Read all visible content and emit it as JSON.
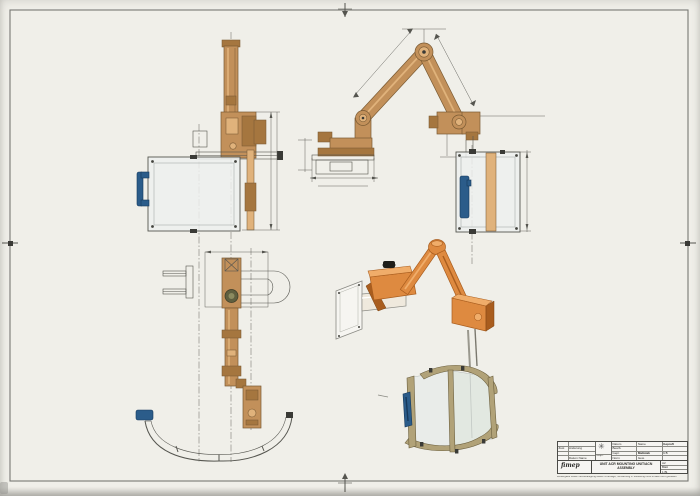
{
  "colors": {
    "paper": "#f0efe9",
    "frame": "#787874",
    "line": "#55554f",
    "tan": "#c2905a",
    "tan_l": "#e0b27b",
    "tan_dk": "#7a5a33",
    "tan_d2": "#a5763f",
    "org": "#de8a40",
    "org_l": "#f0ad6a",
    "org_dk": "#a95d1e",
    "blue": "#2b5c8a",
    "blue_dk": "#16395c",
    "panel": "#edf0ee",
    "glass": "#e7ebe9",
    "sf": "#b1a278",
    "sf_dk": "#6d6140",
    "dark": "#3a3a36"
  },
  "title_block": {
    "logo_mark": "✳",
    "left_rows": [
      {
        "a": "",
        "b": ""
      },
      {
        "a": "Zust",
        "b": "Änderung"
      },
      {
        "a": "",
        "b": ""
      },
      {
        "a": "",
        "b": "Datum  Name"
      }
    ],
    "mid_row": "Urspr.",
    "right": {
      "r1a": "Datum",
      "r1b": "Name",
      "r1c": "Gepruft",
      "r2a": "Bearb.",
      "r2b": "",
      "r2c": "",
      "r3a": "Gepr.",
      "r3b": "Maßstab",
      "r3c": "1:5",
      "r4a": "Norm",
      "r4b": "Gew.",
      "r4c": ""
    },
    "company_script": "fimep",
    "title_line1": "UNIT ACR MOUNTING  UNIT/ACN",
    "title_line2": "ASSEMBLY",
    "sheet_rows": [
      "A2",
      "Blatt",
      "1 Bl."
    ],
    "note": "Weitergabe sowie Vervielfältigung dieser Unterlage, Verwertung u. Mitteilung ihres Inhalts nicht gestattet"
  }
}
